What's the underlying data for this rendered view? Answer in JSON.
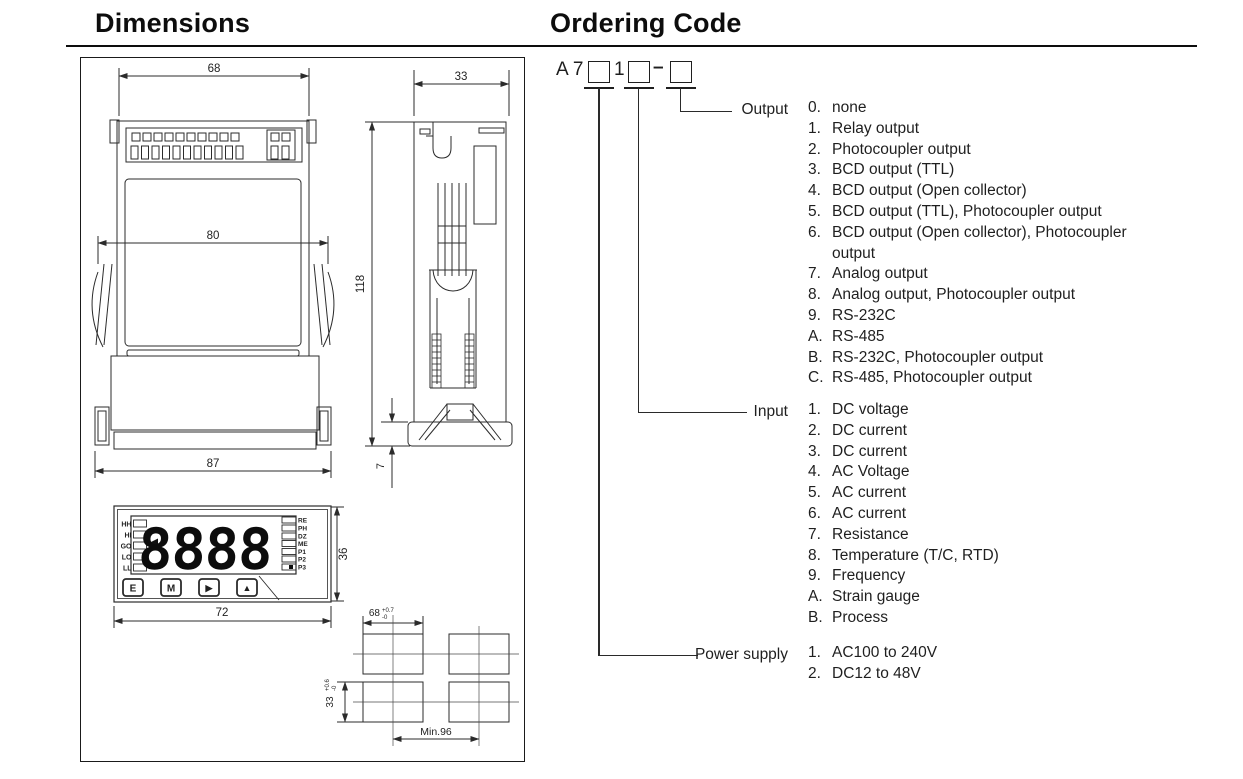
{
  "titles": {
    "dimensions": "Dimensions",
    "ordering": "Ordering Code"
  },
  "ordering": {
    "code": {
      "prefix": "A 7",
      "mid": "1",
      "dash": "–"
    },
    "groups": [
      {
        "label": "Output",
        "items": [
          {
            "key": "0.",
            "text": "none"
          },
          {
            "key": "1.",
            "text": "Relay output"
          },
          {
            "key": "2.",
            "text": "Photocoupler output"
          },
          {
            "key": "3.",
            "text": "BCD output (TTL)"
          },
          {
            "key": "4.",
            "text": "BCD output (Open collector)"
          },
          {
            "key": "5.",
            "text": "BCD output (TTL), Photocoupler output"
          },
          {
            "key": "6.",
            "text": "BCD output (Open collector), Photocoupler\noutput"
          },
          {
            "key": "7.",
            "text": "Analog output"
          },
          {
            "key": "8.",
            "text": "Analog output, Photocoupler output"
          },
          {
            "key": "9.",
            "text": "RS-232C"
          },
          {
            "key": "A.",
            "text": "RS-485"
          },
          {
            "key": "B.",
            "text": "RS-232C, Photocoupler output"
          },
          {
            "key": "C.",
            "text": "RS-485, Photocoupler output"
          }
        ]
      },
      {
        "label": "Input",
        "items": [
          {
            "key": "1.",
            "text": "DC voltage"
          },
          {
            "key": "2.",
            "text": "DC current"
          },
          {
            "key": "3.",
            "text": "DC current"
          },
          {
            "key": "4.",
            "text": "AC Voltage"
          },
          {
            "key": "5.",
            "text": "AC current"
          },
          {
            "key": "6.",
            "text": "AC current"
          },
          {
            "key": "7.",
            "text": "Resistance"
          },
          {
            "key": "8.",
            "text": "Temperature (T/C, RTD)"
          },
          {
            "key": "9.",
            "text": "Frequency"
          },
          {
            "key": "A.",
            "text": "Strain gauge"
          },
          {
            "key": "B.",
            "text": "Process"
          }
        ]
      },
      {
        "label": "Power supply",
        "items": [
          {
            "key": "1.",
            "text": "AC100 to 240V"
          },
          {
            "key": "2.",
            "text": "DC12 to 48V"
          }
        ]
      }
    ]
  },
  "drawing": {
    "rear_view": {
      "width_top": "68",
      "width_mid": "80",
      "width_bottom": "87"
    },
    "side_view": {
      "width": "33",
      "height": "118",
      "flange": "7"
    },
    "front_view": {
      "width": "72",
      "height": "36",
      "display_value": "8888",
      "left_indicators": [
        "HH",
        "HI",
        "GO",
        "LO",
        "LL"
      ],
      "right_indicators": [
        "RE",
        "PH",
        "DZ",
        "ME",
        "P1",
        "P2",
        "P3"
      ],
      "buttons": [
        "E",
        "M",
        "▶",
        "▲"
      ]
    },
    "cutout": {
      "width": "68",
      "width_tol_upper": "+0.7",
      "width_tol_lower": "-0",
      "height": "33",
      "height_tol_upper": "+0.6",
      "height_tol_lower": "-0",
      "min_spacing": "Min.96"
    }
  }
}
